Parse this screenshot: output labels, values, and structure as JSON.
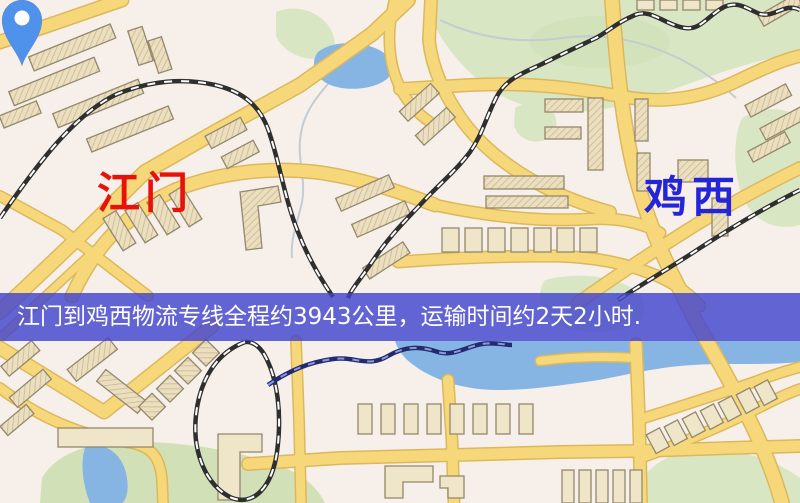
{
  "map": {
    "origin": {
      "label": "江门",
      "label_color": "#e8120a",
      "pin_color": "#ee1408"
    },
    "destination": {
      "label": "鸡西",
      "label_color": "#2424d8",
      "pin_color": "#4e92ec"
    },
    "features": {
      "road_color": "#f6d87b",
      "road_casing_color": "#dcb85c",
      "building_color": "#ebdfc0",
      "railway_color": "#2f2f2f",
      "green_area_color": "#d9e6c4",
      "water_color": "#86b5e4",
      "background_color": "#f7f0ea"
    }
  },
  "banner": {
    "text": "江门到鸡西物流专线全程约3943公里，运输时间约2天2小时.",
    "background_color": "#4244d0",
    "text_color": "#ffffff"
  }
}
